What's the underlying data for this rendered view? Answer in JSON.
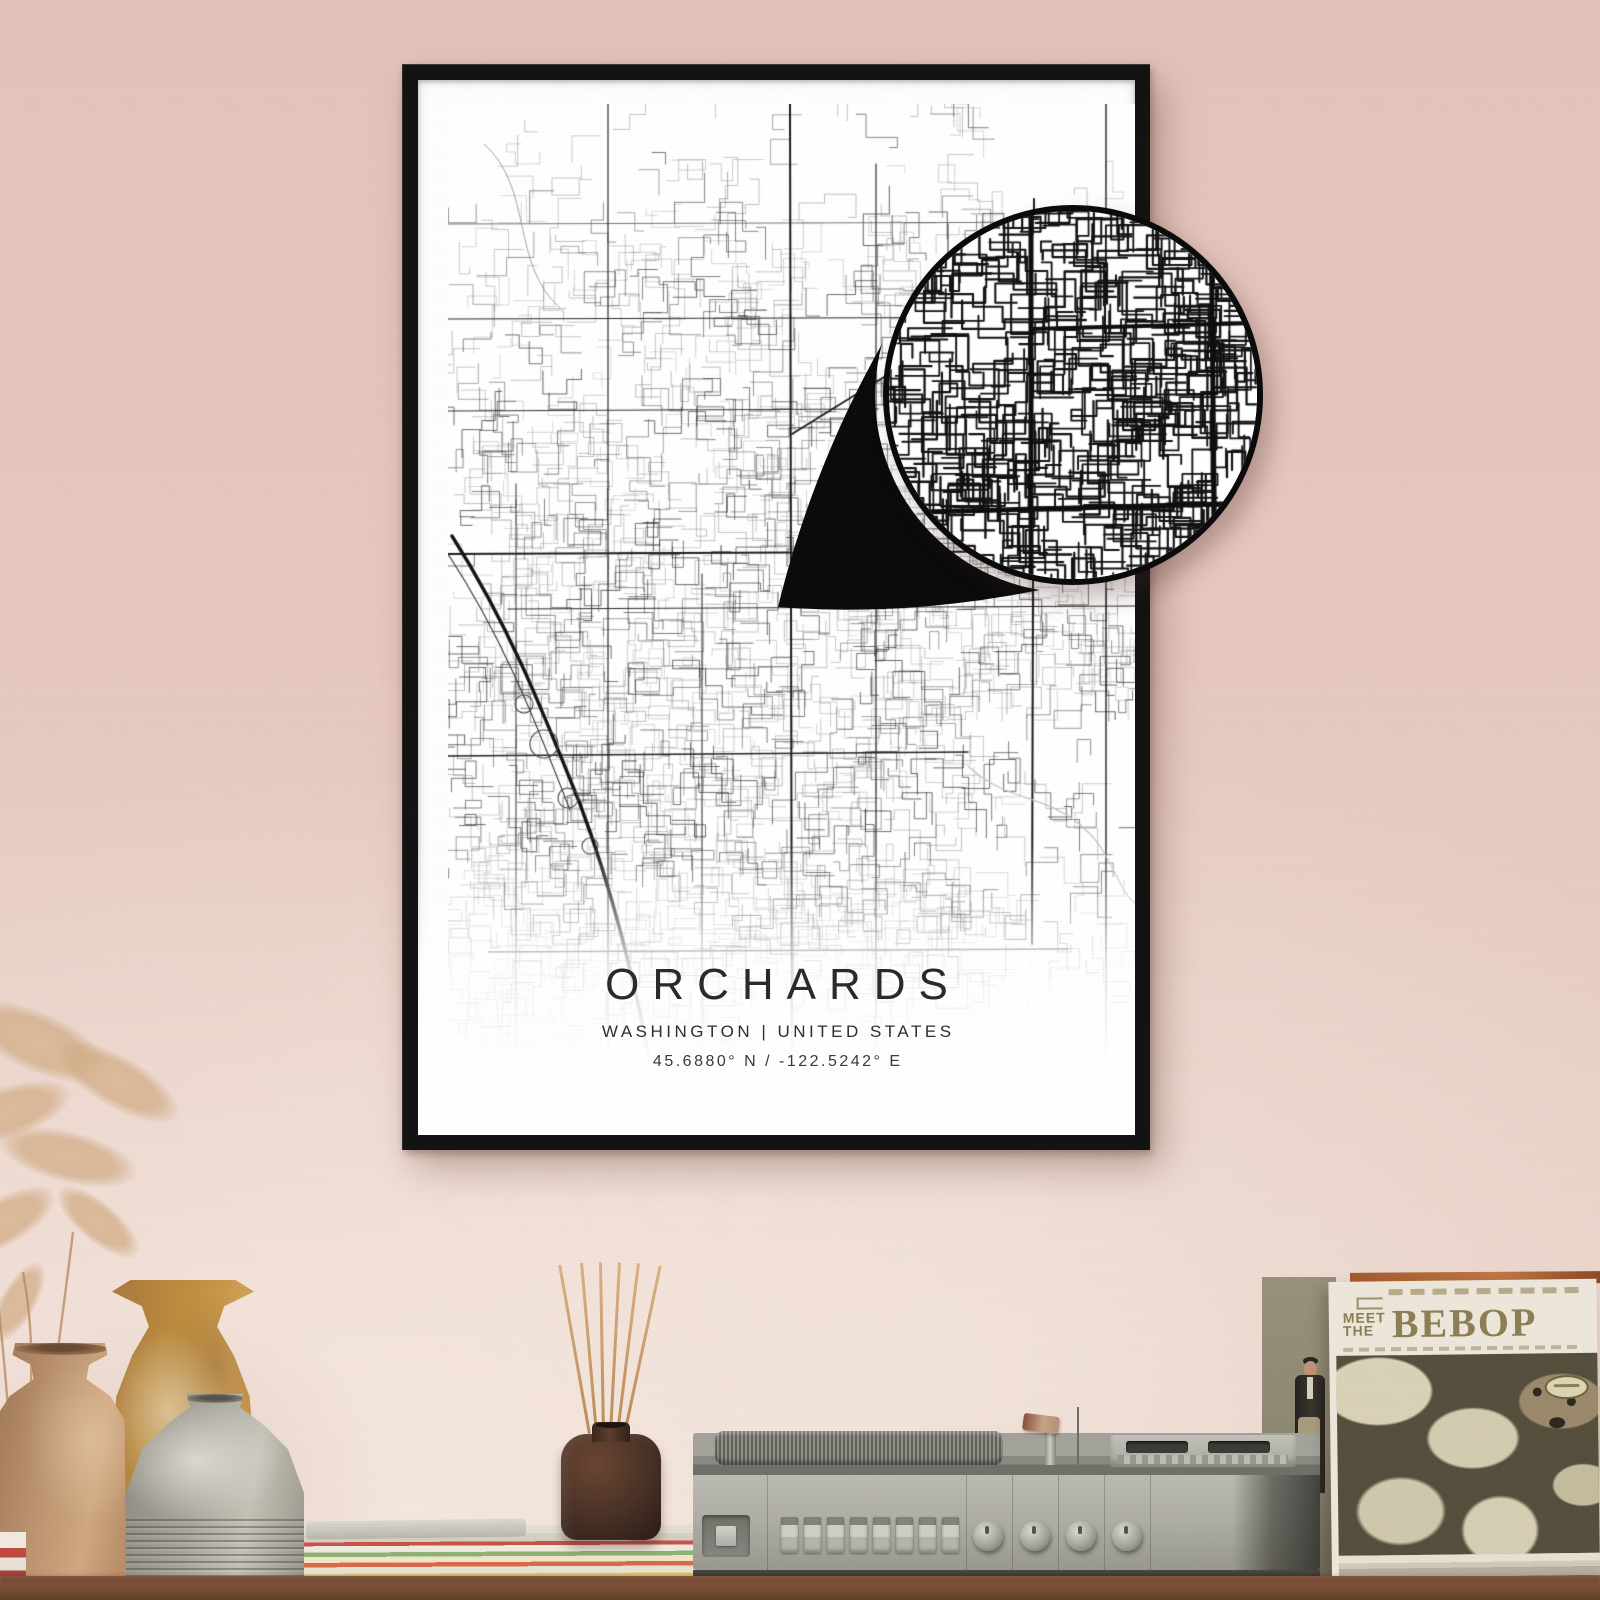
{
  "poster": {
    "title": "ORCHARDS",
    "subtitle": "WASHINGTON | UNITED STATES",
    "coordinates": "45.6880° N / -122.5242° E",
    "frame_color": "#131313",
    "paper_color": "#fefefe",
    "road_major_color": "#1c1c1c",
    "road_minor_color": "#8a8a8a"
  },
  "magnifier": {
    "border_color": "#0b0b0b",
    "pointer_color": "#0b0b0b",
    "background_color": "#ffffff"
  },
  "album": {
    "pretitle_line1": "MEET",
    "pretitle_line2": "THE",
    "title": "BEBOP",
    "title_color": "#8d7e55",
    "cover_color": "#564f3d"
  },
  "record_player": {
    "body_color": "#aeada5",
    "push_button_count": 8,
    "knob_count": 4
  },
  "decor": {
    "wall_color": "#e5c8bf",
    "table_color": "#7e5138",
    "vase_left_color": "#bb9370",
    "vase_back_color": "#c2913f",
    "vase_front_color": "#aaa89d",
    "diffuser_bottle_color": "#4a3226",
    "diffuser_stick_color": "#c79a6d",
    "pampas_color": "#d8b796"
  }
}
